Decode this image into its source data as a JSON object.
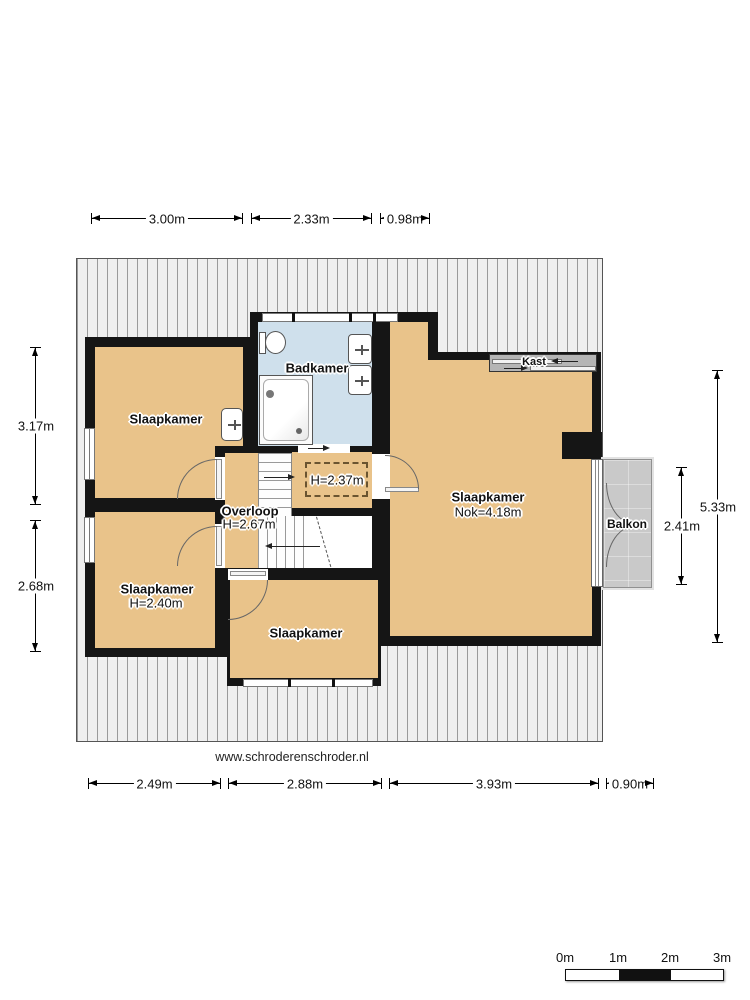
{
  "floorplan": {
    "website": "www.schroderenschroder.nl",
    "rooms": {
      "bedroom_top_left": {
        "label": "Slaapkamer"
      },
      "bathroom": {
        "label": "Badkamer"
      },
      "closet": {
        "label": "Kast"
      },
      "bedroom_right": {
        "label": "Slaapkamer",
        "height_note": "Nok=4.18m"
      },
      "landing": {
        "label": "Overloop",
        "height_note": "H=2.67m"
      },
      "low_ceiling_zone": {
        "label": "H=2.37m"
      },
      "bedroom_bottom_left": {
        "label": "Slaapkamer",
        "height_note": "H=2.40m"
      },
      "bedroom_bottom_middle": {
        "label": "Slaapkamer"
      },
      "balcony": {
        "label": "Balkon"
      }
    },
    "dimensions": {
      "top": [
        "3.00m",
        "2.33m",
        "0.98m"
      ],
      "bottom": [
        "2.49m",
        "2.88m",
        "3.93m",
        "0.90m"
      ],
      "left": [
        "3.17m",
        "2.68m"
      ],
      "right_inner": "2.41m",
      "right_outer": "5.33m"
    },
    "scale_bar": {
      "labels": [
        "0m",
        "1m",
        "2m",
        "3m"
      ]
    },
    "colors": {
      "wall": "#151515",
      "room_fill": "#e9c38a",
      "bathroom_fill": "#cfe0ec",
      "balcony_fill": "#c9c9c9",
      "closet_fill": "#b5b5b5",
      "hatch_bg": "#efefef",
      "hatch_line": "#9a9a9a"
    }
  }
}
